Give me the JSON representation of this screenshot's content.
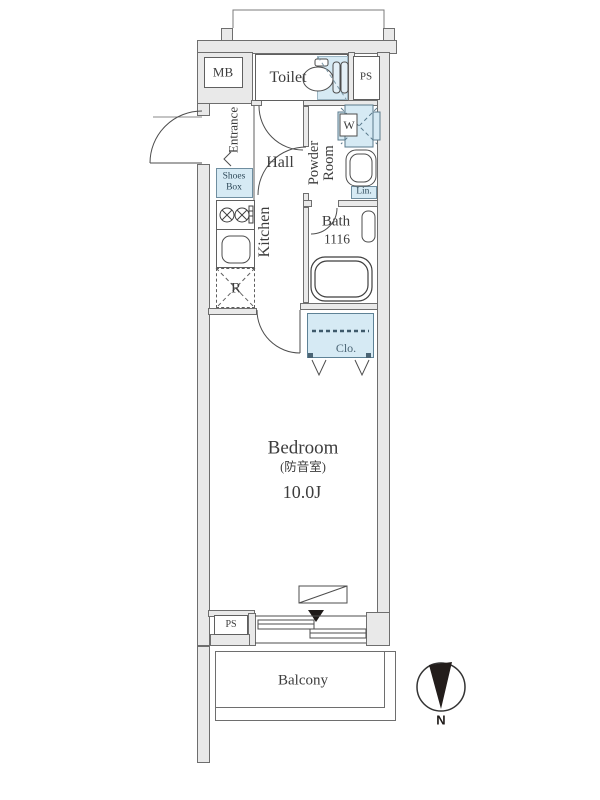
{
  "colors": {
    "wall_fill": "#e9e9e9",
    "line": "#5f5f5f",
    "accent_blue": "#d6eaf4",
    "text": "#3d3d3d",
    "compass_dark": "#231d1b"
  },
  "labels": {
    "mb": "MB",
    "toilet": "Toilet",
    "ps_top": "PS",
    "ps_bottom": "PS",
    "entrance": "Entrance",
    "shoes1": "Shoes",
    "shoes2": "Box",
    "hall": "Hall",
    "powder1": "Powder",
    "powder2": "Room",
    "washer": "W",
    "linen": "Lin.",
    "kitchen": "Kitchen",
    "fridge": "R",
    "bath": "Bath",
    "bath_size": "1116",
    "closet": "Clo.",
    "bedroom": "Bedroom",
    "bedroom_note": "(防音室)",
    "bedroom_size": "10.0J",
    "balcony": "Balcony",
    "north": "N"
  }
}
